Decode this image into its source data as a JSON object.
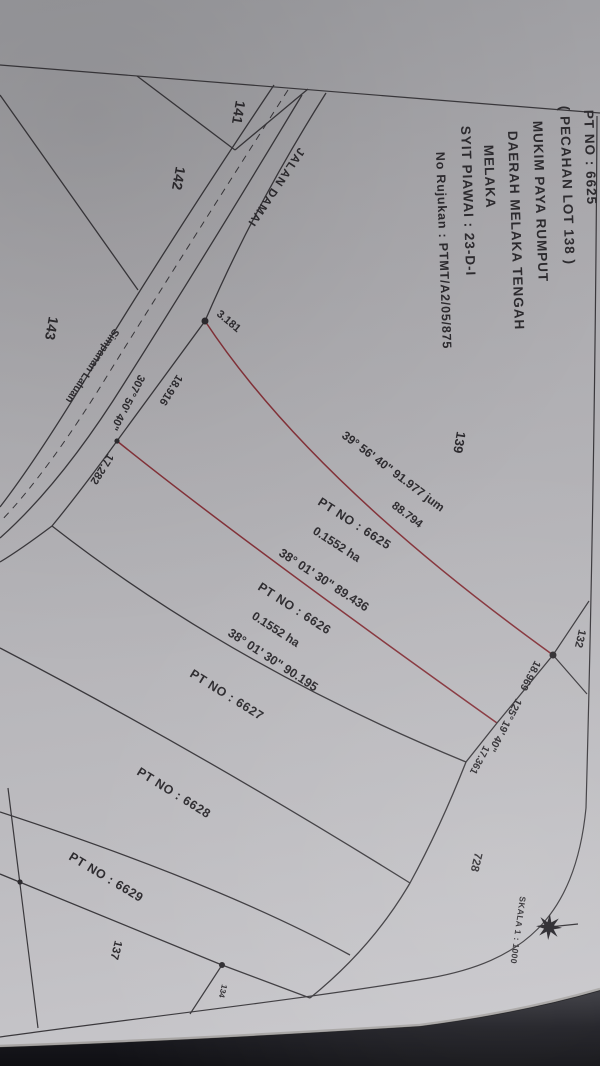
{
  "document": {
    "title_block": {
      "lines": [
        "PT NO : 6625",
        "( PECAHAN LOT 138 )",
        "MUKIM PAYA RUMPUT",
        "DAERAH MELAKA TENGAH",
        "MELAKA",
        "SYIT PIAWAI : 23-D-I",
        "No Rujukan : PTMT/A2/05/875"
      ]
    },
    "road": {
      "name": "JALAN DAMAI",
      "reserve": "Simpanan  Laluan"
    },
    "parcels": [
      {
        "id": "PT NO : 6625",
        "area": "0.1552 ha"
      },
      {
        "id": "PT NO : 6626",
        "area": "0.1552 ha"
      },
      {
        "id": "PT NO : 6627"
      },
      {
        "id": "PT NO : 6628"
      },
      {
        "id": "PT NO : 6629"
      }
    ],
    "adjacent_lots": {
      "l141": "141",
      "l142": "142",
      "l143": "143",
      "l139": "139",
      "l132": "132",
      "l728": "728",
      "l137": "137",
      "l134": "134"
    },
    "dimensions": {
      "ne_bearing": "39° 56' 40\" 91.977 jum",
      "ne_part": "88.794",
      "tie": "3.181",
      "b_6625_6626": "38° 01' 30\" 89.436",
      "b_6626_6627": "38° 01' 30\" 90.195",
      "frontage_bearing": "307° 50' 40\"",
      "frontage_6625": "18.916",
      "frontage_6626": "17.282",
      "rear_6625": "18.969",
      "rear_bearing": "125° 19' 40\"",
      "rear_6626": "17.361"
    },
    "scale_label": "SKALA 1 : 1000",
    "colors": {
      "paper": "#b4b3b7",
      "ink": "#2d2b2f",
      "boundary_highlight": "#8a3038",
      "background": "#17171b"
    }
  }
}
